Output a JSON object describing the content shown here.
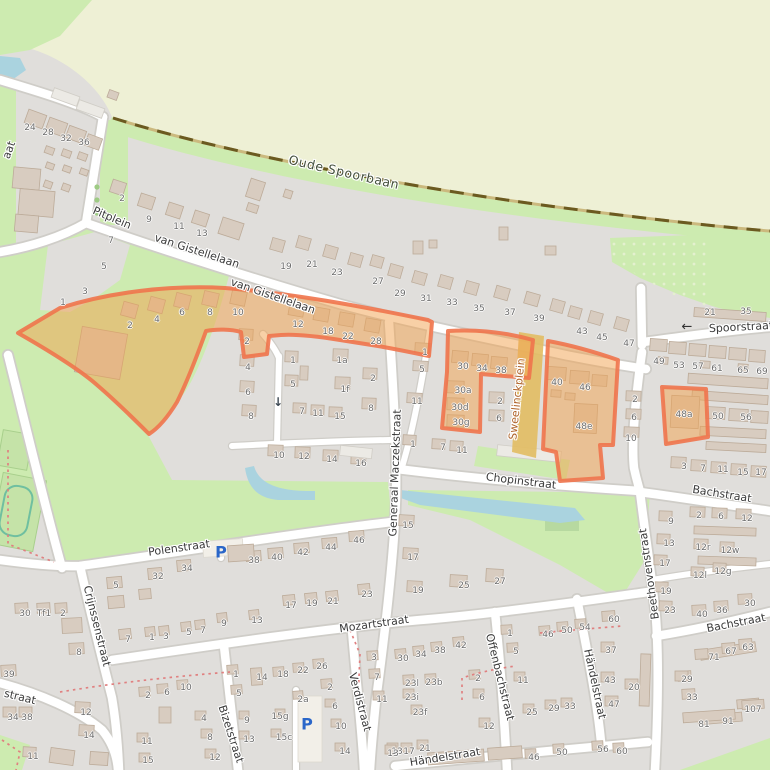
{
  "map": {
    "colors": {
      "residential": "#e0dedb",
      "field": "#eef0d5",
      "grass": "#cdebb0",
      "water": "#aad3df",
      "road": "#ffffff",
      "road_casing": "#cfcdc8",
      "building": "#d8ccc0",
      "building_outline": "#bcab99",
      "railway": "#6b5a20",
      "highlight_fill": "#f2a24e",
      "highlight_border": "#f0744c",
      "street_label": "#3a3a3a",
      "housenumber": "#6d6d6d",
      "parking": "#2a66c9",
      "sweelinck_label": "#b0652c"
    },
    "street_labels": [
      {
        "text": "Oude Spoorbaan",
        "x": 344,
        "y": 172,
        "rot": 13,
        "size": 12.5,
        "ls": 0.6,
        "color": "#44503c"
      },
      {
        "text": "Pitplein",
        "x": 112,
        "y": 218,
        "rot": 23
      },
      {
        "text": "van Gistellelaan",
        "x": 197,
        "y": 251,
        "rot": 18
      },
      {
        "text": "van Gistellelaan",
        "x": 273,
        "y": 296,
        "rot": 19
      },
      {
        "text": "Spoorstraat",
        "x": 741,
        "y": 327,
        "rot": -3
      },
      {
        "text": "Sweelinckplein",
        "x": 517,
        "y": 399,
        "rot": -84,
        "color": "#b0652c"
      },
      {
        "text": "Generaal Maczekstraat",
        "x": 395,
        "y": 473,
        "rot": -88
      },
      {
        "text": "Chopinstraat",
        "x": 521,
        "y": 481,
        "rot": 7
      },
      {
        "text": "Bachstraat",
        "x": 722,
        "y": 494,
        "rot": 9
      },
      {
        "text": "Beethovenstraat",
        "x": 649,
        "y": 574,
        "rot": -98
      },
      {
        "text": "Bachstraat",
        "x": 736,
        "y": 623,
        "rot": -11
      },
      {
        "text": "Polenstraat",
        "x": 179,
        "y": 548,
        "rot": -8
      },
      {
        "text": "Crijnssenstraat",
        "x": 97,
        "y": 626,
        "rot": 76
      },
      {
        "text": "Mozartstraat",
        "x": 374,
        "y": 624,
        "rot": -8
      },
      {
        "text": "Offenbachstraat",
        "x": 500,
        "y": 677,
        "rot": 76
      },
      {
        "text": "Verdistraat",
        "x": 360,
        "y": 702,
        "rot": 75
      },
      {
        "text": "Bizetstraat",
        "x": 231,
        "y": 734,
        "rot": 72
      },
      {
        "text": "Händelstraat",
        "x": 595,
        "y": 684,
        "rot": 78
      },
      {
        "text": "Händelstraat",
        "x": 445,
        "y": 757,
        "rot": -9
      },
      {
        "text": "straat",
        "x": 20,
        "y": 697,
        "rot": 14
      },
      {
        "text": "aat",
        "x": 9,
        "y": 150,
        "rot": -70
      }
    ],
    "house_numbers": [
      {
        "t": "24",
        "x": 30,
        "y": 128
      },
      {
        "t": "28",
        "x": 48,
        "y": 133
      },
      {
        "t": "32",
        "x": 66,
        "y": 139
      },
      {
        "t": "36",
        "x": 84,
        "y": 143
      },
      {
        "t": "2",
        "x": 122,
        "y": 199
      },
      {
        "t": "9",
        "x": 149,
        "y": 220
      },
      {
        "t": "11",
        "x": 179,
        "y": 227
      },
      {
        "t": "13",
        "x": 202,
        "y": 234
      },
      {
        "t": "7",
        "x": 111,
        "y": 241
      },
      {
        "t": "5",
        "x": 104,
        "y": 267
      },
      {
        "t": "3",
        "x": 85,
        "y": 292
      },
      {
        "t": "1",
        "x": 63,
        "y": 303
      },
      {
        "t": "19",
        "x": 286,
        "y": 267
      },
      {
        "t": "21",
        "x": 312,
        "y": 265
      },
      {
        "t": "23",
        "x": 337,
        "y": 273
      },
      {
        "t": "27",
        "x": 378,
        "y": 282
      },
      {
        "t": "29",
        "x": 400,
        "y": 294
      },
      {
        "t": "31",
        "x": 426,
        "y": 299
      },
      {
        "t": "33",
        "x": 452,
        "y": 303
      },
      {
        "t": "35",
        "x": 479,
        "y": 309
      },
      {
        "t": "37",
        "x": 510,
        "y": 313
      },
      {
        "t": "39",
        "x": 539,
        "y": 319
      },
      {
        "t": "43",
        "x": 582,
        "y": 332
      },
      {
        "t": "45",
        "x": 602,
        "y": 338
      },
      {
        "t": "47",
        "x": 629,
        "y": 344
      },
      {
        "t": "21",
        "x": 710,
        "y": 313
      },
      {
        "t": "35",
        "x": 746,
        "y": 312
      },
      {
        "t": "49",
        "x": 659,
        "y": 362
      },
      {
        "t": "53",
        "x": 679,
        "y": 366
      },
      {
        "t": "57",
        "x": 698,
        "y": 367
      },
      {
        "t": "61",
        "x": 717,
        "y": 369
      },
      {
        "t": "65",
        "x": 743,
        "y": 371
      },
      {
        "t": "69",
        "x": 762,
        "y": 372
      },
      {
        "t": "2",
        "x": 130,
        "y": 326
      },
      {
        "t": "4",
        "x": 157,
        "y": 320
      },
      {
        "t": "6",
        "x": 182,
        "y": 313
      },
      {
        "t": "8",
        "x": 210,
        "y": 313
      },
      {
        "t": "10",
        "x": 238,
        "y": 313
      },
      {
        "t": "12",
        "x": 298,
        "y": 325
      },
      {
        "t": "18",
        "x": 328,
        "y": 332
      },
      {
        "t": "22",
        "x": 348,
        "y": 337
      },
      {
        "t": "28",
        "x": 376,
        "y": 342
      },
      {
        "t": "2",
        "x": 247,
        "y": 342
      },
      {
        "t": "4",
        "x": 248,
        "y": 368
      },
      {
        "t": "6",
        "x": 248,
        "y": 393
      },
      {
        "t": "8",
        "x": 251,
        "y": 417
      },
      {
        "t": "1",
        "x": 293,
        "y": 361
      },
      {
        "t": "5",
        "x": 293,
        "y": 385
      },
      {
        "t": "1a",
        "x": 342,
        "y": 361
      },
      {
        "t": "1f",
        "x": 345,
        "y": 390
      },
      {
        "t": "2",
        "x": 373,
        "y": 379
      },
      {
        "t": "8",
        "x": 371,
        "y": 409
      },
      {
        "t": "7",
        "x": 302,
        "y": 412
      },
      {
        "t": "11",
        "x": 318,
        "y": 414
      },
      {
        "t": "15",
        "x": 340,
        "y": 417
      },
      {
        "t": "10",
        "x": 279,
        "y": 456
      },
      {
        "t": "12",
        "x": 304,
        "y": 457
      },
      {
        "t": "14",
        "x": 332,
        "y": 460
      },
      {
        "t": "16",
        "x": 361,
        "y": 464
      },
      {
        "t": "1",
        "x": 425,
        "y": 353
      },
      {
        "t": "5",
        "x": 422,
        "y": 370
      },
      {
        "t": "11",
        "x": 417,
        "y": 402
      },
      {
        "t": "1",
        "x": 413,
        "y": 445
      },
      {
        "t": "7",
        "x": 443,
        "y": 448
      },
      {
        "t": "11",
        "x": 462,
        "y": 451
      },
      {
        "t": "30",
        "x": 463,
        "y": 367
      },
      {
        "t": "34",
        "x": 482,
        "y": 369
      },
      {
        "t": "38",
        "x": 501,
        "y": 371
      },
      {
        "t": "30a",
        "x": 463,
        "y": 391
      },
      {
        "t": "30d",
        "x": 460,
        "y": 408
      },
      {
        "t": "30g",
        "x": 461,
        "y": 423
      },
      {
        "t": "2",
        "x": 500,
        "y": 402
      },
      {
        "t": "6",
        "x": 499,
        "y": 419
      },
      {
        "t": "40",
        "x": 557,
        "y": 383
      },
      {
        "t": "46",
        "x": 585,
        "y": 388
      },
      {
        "t": "48e",
        "x": 584,
        "y": 427
      },
      {
        "t": "2",
        "x": 635,
        "y": 400
      },
      {
        "t": "6",
        "x": 634,
        "y": 418
      },
      {
        "t": "10",
        "x": 631,
        "y": 439
      },
      {
        "t": "48a",
        "x": 684,
        "y": 415
      },
      {
        "t": "50",
        "x": 718,
        "y": 417
      },
      {
        "t": "56",
        "x": 746,
        "y": 418
      },
      {
        "t": "3",
        "x": 684,
        "y": 467
      },
      {
        "t": "7",
        "x": 703,
        "y": 469
      },
      {
        "t": "11",
        "x": 723,
        "y": 470
      },
      {
        "t": "15",
        "x": 743,
        "y": 473
      },
      {
        "t": "17",
        "x": 761,
        "y": 473
      },
      {
        "t": "15",
        "x": 408,
        "y": 526
      },
      {
        "t": "17",
        "x": 413,
        "y": 558
      },
      {
        "t": "19",
        "x": 418,
        "y": 591
      },
      {
        "t": "25",
        "x": 464,
        "y": 586
      },
      {
        "t": "27",
        "x": 500,
        "y": 582
      },
      {
        "t": "9",
        "x": 671,
        "y": 522
      },
      {
        "t": "13",
        "x": 669,
        "y": 544
      },
      {
        "t": "17",
        "x": 665,
        "y": 564
      },
      {
        "t": "19",
        "x": 666,
        "y": 592
      },
      {
        "t": "23",
        "x": 670,
        "y": 611
      },
      {
        "t": "2",
        "x": 699,
        "y": 516
      },
      {
        "t": "6",
        "x": 721,
        "y": 517
      },
      {
        "t": "12",
        "x": 747,
        "y": 519
      },
      {
        "t": "12r",
        "x": 703,
        "y": 548
      },
      {
        "t": "12w",
        "x": 730,
        "y": 551
      },
      {
        "t": "12l",
        "x": 700,
        "y": 576
      },
      {
        "t": "12g",
        "x": 723,
        "y": 572
      },
      {
        "t": "40",
        "x": 702,
        "y": 615
      },
      {
        "t": "36",
        "x": 722,
        "y": 611
      },
      {
        "t": "30",
        "x": 750,
        "y": 604
      },
      {
        "t": "71",
        "x": 714,
        "y": 658
      },
      {
        "t": "67",
        "x": 731,
        "y": 652
      },
      {
        "t": "63",
        "x": 748,
        "y": 648
      },
      {
        "t": "29",
        "x": 687,
        "y": 680
      },
      {
        "t": "33",
        "x": 692,
        "y": 698
      },
      {
        "t": "107",
        "x": 753,
        "y": 710
      },
      {
        "t": "81",
        "x": 704,
        "y": 725
      },
      {
        "t": "91",
        "x": 728,
        "y": 722
      },
      {
        "t": "38",
        "x": 254,
        "y": 561
      },
      {
        "t": "40",
        "x": 277,
        "y": 558
      },
      {
        "t": "42",
        "x": 303,
        "y": 553
      },
      {
        "t": "44",
        "x": 331,
        "y": 548
      },
      {
        "t": "46",
        "x": 359,
        "y": 541
      },
      {
        "t": "5",
        "x": 116,
        "y": 586
      },
      {
        "t": "32",
        "x": 158,
        "y": 577
      },
      {
        "t": "34",
        "x": 187,
        "y": 569
      },
      {
        "t": "7",
        "x": 128,
        "y": 640
      },
      {
        "t": "1",
        "x": 152,
        "y": 638
      },
      {
        "t": "3",
        "x": 166,
        "y": 637
      },
      {
        "t": "5",
        "x": 189,
        "y": 633
      },
      {
        "t": "7",
        "x": 203,
        "y": 631
      },
      {
        "t": "9",
        "x": 224,
        "y": 624
      },
      {
        "t": "13",
        "x": 257,
        "y": 621
      },
      {
        "t": "17",
        "x": 291,
        "y": 606
      },
      {
        "t": "19",
        "x": 312,
        "y": 604
      },
      {
        "t": "21",
        "x": 333,
        "y": 602
      },
      {
        "t": "23",
        "x": 367,
        "y": 595
      },
      {
        "t": "30",
        "x": 25,
        "y": 614
      },
      {
        "t": "Tf1",
        "x": 44,
        "y": 614
      },
      {
        "t": "2",
        "x": 63,
        "y": 614
      },
      {
        "t": "8",
        "x": 79,
        "y": 653
      },
      {
        "t": "39",
        "x": 9,
        "y": 675
      },
      {
        "t": "34",
        "x": 13,
        "y": 718
      },
      {
        "t": "38",
        "x": 27,
        "y": 718
      },
      {
        "t": "12",
        "x": 86,
        "y": 713
      },
      {
        "t": "14",
        "x": 89,
        "y": 736
      },
      {
        "t": "11",
        "x": 33,
        "y": 757
      },
      {
        "t": "14",
        "x": 262,
        "y": 678
      },
      {
        "t": "18",
        "x": 283,
        "y": 675
      },
      {
        "t": "22",
        "x": 303,
        "y": 671
      },
      {
        "t": "26",
        "x": 322,
        "y": 667
      },
      {
        "t": "2",
        "x": 330,
        "y": 688
      },
      {
        "t": "2a",
        "x": 303,
        "y": 700
      },
      {
        "t": "6",
        "x": 335,
        "y": 707
      },
      {
        "t": "10",
        "x": 341,
        "y": 727
      },
      {
        "t": "14",
        "x": 345,
        "y": 752
      },
      {
        "t": "15g",
        "x": 280,
        "y": 717
      },
      {
        "t": "15c",
        "x": 284,
        "y": 738
      },
      {
        "t": "9",
        "x": 247,
        "y": 721
      },
      {
        "t": "13",
        "x": 249,
        "y": 740
      },
      {
        "t": "1",
        "x": 236,
        "y": 675
      },
      {
        "t": "5",
        "x": 239,
        "y": 694
      },
      {
        "t": "2",
        "x": 148,
        "y": 696
      },
      {
        "t": "6",
        "x": 167,
        "y": 693
      },
      {
        "t": "10",
        "x": 186,
        "y": 688
      },
      {
        "t": "4",
        "x": 204,
        "y": 719
      },
      {
        "t": "8",
        "x": 210,
        "y": 738
      },
      {
        "t": "11",
        "x": 147,
        "y": 742
      },
      {
        "t": "15",
        "x": 148,
        "y": 761
      },
      {
        "t": "12",
        "x": 215,
        "y": 758
      },
      {
        "t": "3",
        "x": 374,
        "y": 658
      },
      {
        "t": "7",
        "x": 377,
        "y": 678
      },
      {
        "t": "11",
        "x": 382,
        "y": 700
      },
      {
        "t": "13",
        "x": 397,
        "y": 752
      },
      {
        "t": "30",
        "x": 403,
        "y": 659
      },
      {
        "t": "34",
        "x": 421,
        "y": 655
      },
      {
        "t": "38",
        "x": 440,
        "y": 651
      },
      {
        "t": "42",
        "x": 461,
        "y": 646
      },
      {
        "t": "23l",
        "x": 412,
        "y": 684
      },
      {
        "t": "23b",
        "x": 434,
        "y": 683
      },
      {
        "t": "23i",
        "x": 412,
        "y": 698
      },
      {
        "t": "23f",
        "x": 420,
        "y": 713
      },
      {
        "t": "2",
        "x": 478,
        "y": 679
      },
      {
        "t": "6",
        "x": 482,
        "y": 698
      },
      {
        "t": "12",
        "x": 489,
        "y": 727
      },
      {
        "t": "13",
        "x": 393,
        "y": 754
      },
      {
        "t": "17",
        "x": 409,
        "y": 752
      },
      {
        "t": "21",
        "x": 425,
        "y": 749
      },
      {
        "t": "1",
        "x": 510,
        "y": 634
      },
      {
        "t": "5",
        "x": 516,
        "y": 652
      },
      {
        "t": "11",
        "x": 523,
        "y": 681
      },
      {
        "t": "25",
        "x": 532,
        "y": 713
      },
      {
        "t": "29",
        "x": 554,
        "y": 709
      },
      {
        "t": "33",
        "x": 570,
        "y": 707
      },
      {
        "t": "46",
        "x": 548,
        "y": 635
      },
      {
        "t": "50",
        "x": 567,
        "y": 631
      },
      {
        "t": "54",
        "x": 585,
        "y": 628
      },
      {
        "t": "60",
        "x": 614,
        "y": 620
      },
      {
        "t": "37",
        "x": 611,
        "y": 651
      },
      {
        "t": "43",
        "x": 610,
        "y": 681
      },
      {
        "t": "20",
        "x": 634,
        "y": 688
      },
      {
        "t": "47",
        "x": 614,
        "y": 705
      },
      {
        "t": "46",
        "x": 534,
        "y": 758
      },
      {
        "t": "50",
        "x": 562,
        "y": 753
      },
      {
        "t": "56",
        "x": 603,
        "y": 750
      },
      {
        "t": "60",
        "x": 622,
        "y": 752
      }
    ],
    "icons": [
      {
        "type": "parking",
        "glyph": "P",
        "x": 221,
        "y": 552
      },
      {
        "type": "parking",
        "glyph": "P",
        "x": 307,
        "y": 724
      },
      {
        "type": "oneway-down",
        "glyph": "↓",
        "x": 278,
        "y": 402
      },
      {
        "type": "oneway-left",
        "glyph": "←",
        "x": 687,
        "y": 327
      }
    ]
  }
}
